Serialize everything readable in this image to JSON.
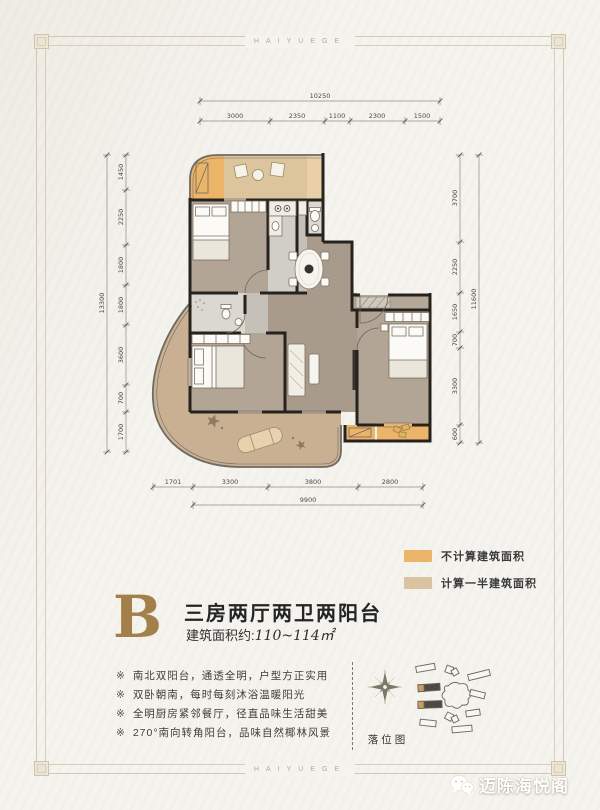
{
  "frame": {
    "brand_letters": "HAIYUEGE"
  },
  "plan": {
    "dimensions": {
      "top": {
        "total": "10250",
        "segments": [
          "3000",
          "2350",
          "1100",
          "2300",
          "1500"
        ]
      },
      "left": {
        "total": "13300",
        "segments": [
          "1450",
          "2250",
          "1800",
          "1800",
          "3600",
          "700",
          "1700"
        ]
      },
      "right": {
        "total": "11600",
        "segments": [
          "3700",
          "2250",
          "1650",
          "700",
          "3300",
          "600"
        ]
      },
      "bottom": {
        "total": "9900",
        "segments": [
          "1701",
          "3300",
          "3800",
          "2800"
        ]
      }
    },
    "legend": [
      {
        "label": "不计算建筑面积",
        "color": "#ecb468"
      },
      {
        "label": "计算一半建筑面积",
        "color": "#d9c3a0"
      }
    ]
  },
  "unit": {
    "letter": "B",
    "title": "三房两厅两卫两阳台",
    "area_prefix": "建筑面积约:",
    "area_value": "110~114㎡"
  },
  "features": {
    "marker": "※",
    "items": [
      "南北双阳台，通透全明，户型方正实用",
      "双卧朝南，每时每刻沐浴温暖阳光",
      "全明厨房紧邻餐厅，径直品味生活甜美",
      "270°南向转角阳台，品味自然椰林风景"
    ]
  },
  "site_map": {
    "label": "落位图"
  },
  "watermark": {
    "text": "迈陈海悦阁"
  },
  "colors": {
    "accent_gold": "#a3804a",
    "no_count_area": "#ecb468",
    "half_count_area": "#d9c3a0",
    "wall": "#26221e",
    "frame_line": "#d3c9b2",
    "paper": "#f5f3ee"
  }
}
